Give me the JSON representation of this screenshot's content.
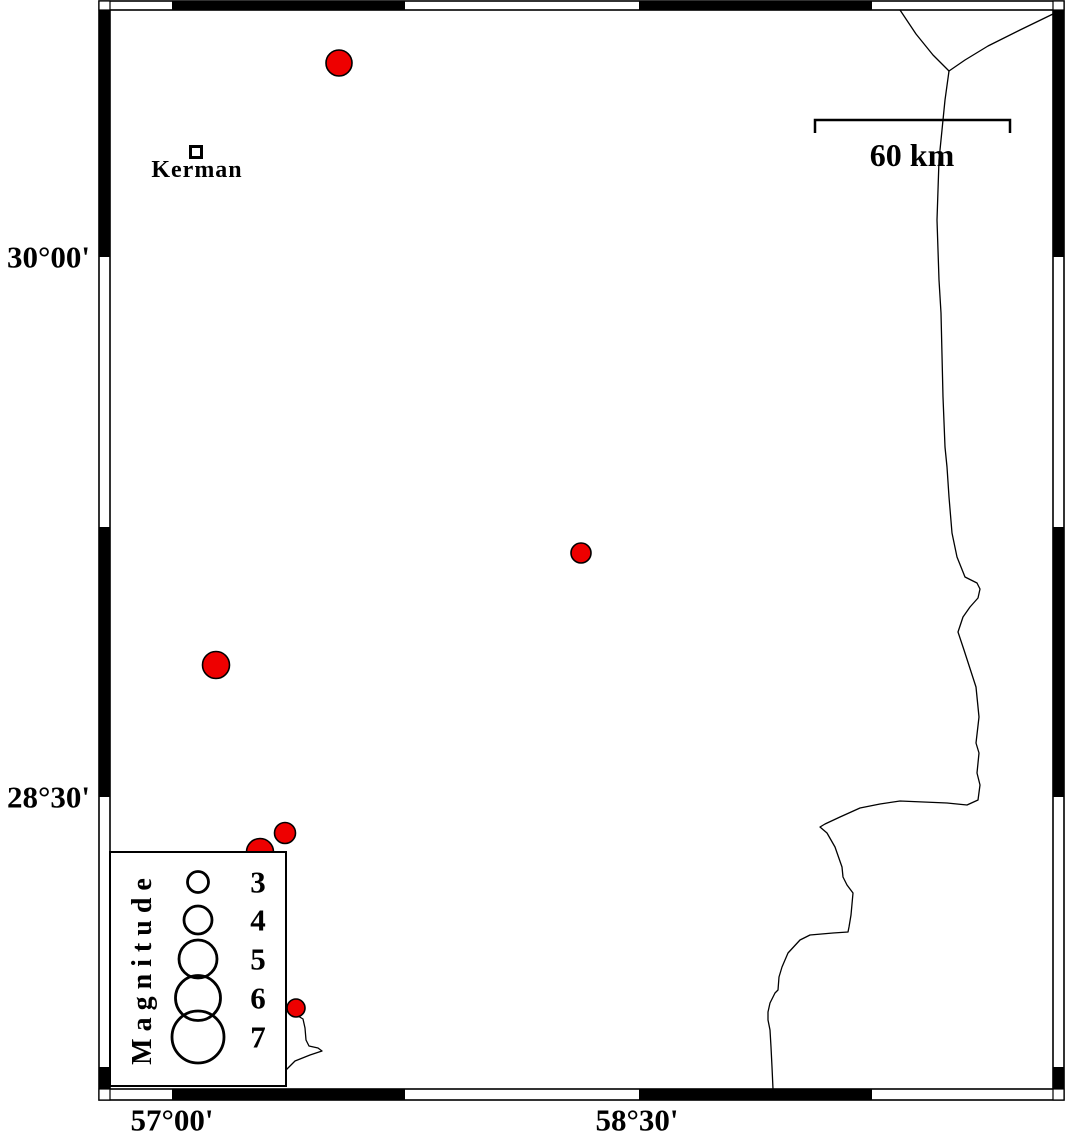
{
  "map": {
    "background_color": "#ffffff",
    "line_color": "#000000",
    "epicenter_color": "#ee0000",
    "frame": {
      "outer": {
        "x": 99,
        "y": 1,
        "w": 965,
        "h": 1099
      },
      "inner": {
        "x": 110,
        "y": 10,
        "w": 943,
        "h": 1079
      },
      "top_black_segments_x": [
        [
          172,
          405
        ],
        [
          639,
          872
        ]
      ],
      "bottom_black_segments_x": [
        [
          172,
          405
        ],
        [
          639,
          872
        ]
      ],
      "left_black_segments_y": [
        [
          10,
          257
        ],
        [
          527,
          797
        ],
        [
          1067,
          1089
        ]
      ],
      "right_black_segments_y": [
        [
          10,
          257
        ],
        [
          527,
          797
        ],
        [
          1067,
          1089
        ]
      ]
    },
    "axis_labels": {
      "left": [
        {
          "text": "30°00'",
          "x": 90,
          "y": 257
        },
        {
          "text": "28°30'",
          "x": 90,
          "y": 797
        }
      ],
      "bottom": [
        {
          "text": "57°00'",
          "x": 172,
          "y": 1120
        },
        {
          "text": "58°30'",
          "x": 637,
          "y": 1120
        }
      ]
    },
    "city": {
      "name": "Kerman",
      "marker": {
        "x": 196,
        "y": 152,
        "size": 11
      },
      "label_pos": {
        "x": 197,
        "y": 170
      }
    },
    "scale_bar": {
      "label": "60 km",
      "x1": 815,
      "x2": 1010,
      "y": 120,
      "tick_drop": 13,
      "label_pos": {
        "x": 912,
        "y": 155
      }
    },
    "epicenters": [
      {
        "x": 339,
        "y": 63,
        "r": 13
      },
      {
        "x": 581,
        "y": 553,
        "r": 10
      },
      {
        "x": 216,
        "y": 665,
        "r": 13.5
      },
      {
        "x": 260,
        "y": 852,
        "r": 13.5
      },
      {
        "x": 285,
        "y": 833,
        "r": 10.5
      },
      {
        "x": 296,
        "y": 1008,
        "r": 9
      }
    ],
    "legend": {
      "title": "Magnitude",
      "box": {
        "x": 110,
        "y": 852,
        "w": 176,
        "h": 234
      },
      "circle_cx": 198,
      "label_x": 258,
      "title_pos": {
        "x": 143,
        "y": 968
      },
      "entries": [
        {
          "label": "3",
          "r": 10.5,
          "cy": 882
        },
        {
          "label": "4",
          "r": 14,
          "cy": 920
        },
        {
          "label": "5",
          "r": 19,
          "cy": 959
        },
        {
          "label": "6",
          "r": 22.5,
          "cy": 998
        },
        {
          "label": "7",
          "r": 26,
          "cy": 1037
        }
      ]
    },
    "roads": [
      [
        [
          900,
          10
        ],
        [
          916,
          34
        ],
        [
          933,
          55
        ],
        [
          949,
          71
        ]
      ],
      [
        [
          1053,
          14
        ],
        [
          1020,
          30
        ],
        [
          988,
          46
        ],
        [
          965,
          60
        ],
        [
          949,
          71
        ]
      ],
      [
        [
          949,
          71
        ],
        [
          945,
          100
        ],
        [
          939,
          160
        ],
        [
          937,
          220
        ],
        [
          939,
          280
        ],
        [
          941,
          313
        ],
        [
          943,
          397
        ],
        [
          945,
          447
        ],
        [
          947,
          467
        ],
        [
          949,
          497
        ],
        [
          952,
          533
        ],
        [
          957,
          557
        ],
        [
          965,
          577
        ],
        [
          977,
          583
        ],
        [
          980,
          589
        ],
        [
          978,
          598
        ],
        [
          970,
          607
        ],
        [
          963,
          617
        ],
        [
          958,
          632
        ],
        [
          964,
          650
        ],
        [
          976,
          687
        ],
        [
          979,
          717
        ],
        [
          976,
          743
        ],
        [
          979,
          753
        ],
        [
          977,
          773
        ],
        [
          980,
          785
        ],
        [
          978,
          800
        ],
        [
          967,
          805
        ],
        [
          947,
          803
        ],
        [
          900,
          801
        ],
        [
          880,
          804
        ],
        [
          860,
          808
        ],
        [
          840,
          817
        ],
        [
          825,
          824
        ],
        [
          820,
          827
        ],
        [
          827,
          833
        ],
        [
          835,
          847
        ],
        [
          842,
          867
        ],
        [
          843,
          877
        ],
        [
          847,
          885
        ],
        [
          853,
          893
        ],
        [
          851,
          915
        ],
        [
          849,
          927
        ],
        [
          848,
          932
        ],
        [
          833,
          933
        ],
        [
          810,
          935
        ],
        [
          800,
          940
        ],
        [
          788,
          953
        ],
        [
          782,
          967
        ],
        [
          779,
          977
        ],
        [
          778,
          990
        ],
        [
          775,
          993
        ],
        [
          770,
          1003
        ],
        [
          768,
          1012
        ],
        [
          768,
          1020
        ],
        [
          770,
          1030
        ],
        [
          771,
          1047
        ],
        [
          772,
          1067
        ],
        [
          773,
          1089
        ]
      ],
      [
        [
          298,
          1016
        ],
        [
          303,
          1019
        ],
        [
          305,
          1028
        ],
        [
          306,
          1040
        ],
        [
          309,
          1046
        ],
        [
          318,
          1048
        ],
        [
          322,
          1051
        ],
        [
          310,
          1055
        ],
        [
          295,
          1061
        ],
        [
          286,
          1070
        ]
      ]
    ]
  }
}
